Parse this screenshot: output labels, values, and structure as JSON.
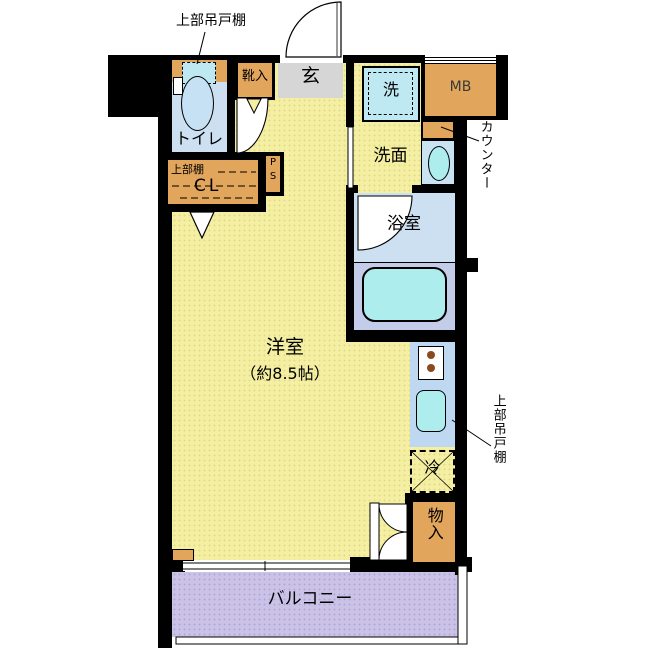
{
  "colors": {
    "wall": "#000000",
    "text": "#000000",
    "mb_text": "#3a3a3a",
    "floor": "#F4EFA2",
    "entry_floor": "#D6D6D6",
    "wet_floor": "#CDE0F2",
    "tub_zone": "#C3CCE8",
    "fixture": "#AEEDEE",
    "washer_box": "#BFE9F2",
    "kitchen_counter": "#BDD8F0",
    "cabinet": "#E2A55C",
    "balcony": "#CBC3E7",
    "burner": "#8B4A1E"
  },
  "rooms": {
    "main_room": {
      "label": "洋室",
      "size": "（約8.5帖）"
    },
    "entrance": {
      "label": "玄"
    },
    "toilet": {
      "label": "トイレ"
    },
    "washroom": {
      "label": "洗面"
    },
    "bathroom": {
      "label": "浴室"
    },
    "balcony": {
      "label": "バルコニー"
    },
    "storage": {
      "label": "物入"
    },
    "closet": {
      "shelf_label": "上部棚",
      "label": "CL"
    },
    "pipe_space": {
      "p": "P",
      "s": "S"
    }
  },
  "fixtures": {
    "washer": {
      "label": "洗"
    },
    "fridge": {
      "label": "冷"
    },
    "meter_box": {
      "label": "MB"
    },
    "shoe_cabinet": {
      "label": "靴入"
    }
  },
  "annotations": {
    "upper_cabinet_top": {
      "label": "上部吊戸棚"
    },
    "counter": {
      "label": "カウンター"
    },
    "upper_cabinet_right": {
      "label": "上部吊戸棚"
    }
  }
}
